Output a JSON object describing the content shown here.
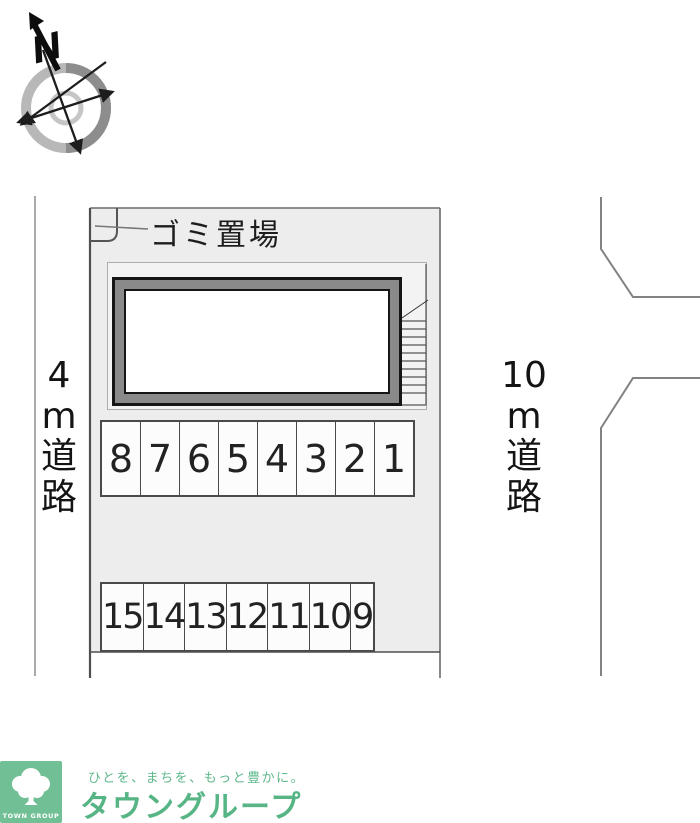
{
  "compass": {
    "north_label": "N"
  },
  "map": {
    "garbage_label": "ゴミ置場",
    "left_road": {
      "text": "4m道路",
      "lines": [
        "4",
        "m",
        "道",
        "路"
      ]
    },
    "right_road": {
      "text": "10m道路",
      "lines": [
        "10",
        "m",
        "道",
        "路"
      ]
    },
    "parking": {
      "row1": [
        "8",
        "7",
        "6",
        "5",
        "4",
        "3",
        "2",
        "1"
      ],
      "row2": [
        "15",
        "14",
        "13",
        "12",
        "11",
        "10",
        "9"
      ]
    },
    "colors": {
      "property_fill": "#ededed",
      "inner_site_fill": "#f3f3f3",
      "building_band_gray": "#8a8a8a",
      "line_dark": "#4a4a4a"
    }
  },
  "footer": {
    "logo_text": "TOWN GROUP",
    "slogan": "ひとを、まちを、もっと豊かに。",
    "brand": "タウングループ",
    "colors": {
      "logo_bg": "#71bf94",
      "brand_green": "#57b585"
    }
  }
}
